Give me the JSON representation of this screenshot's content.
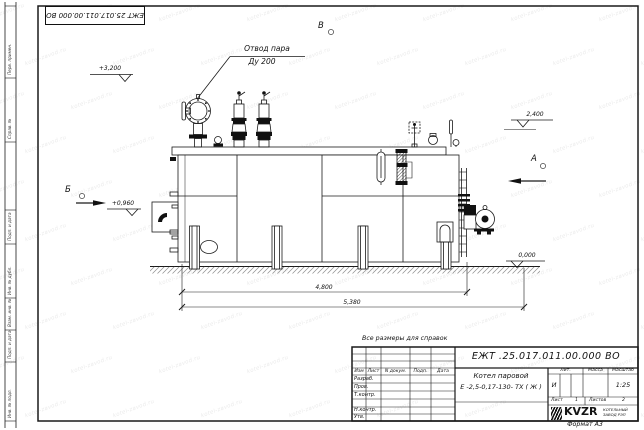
{
  "sheet": {
    "watermark": "kotel-zavod.ru",
    "format_note": "Формат А3",
    "reference_note": "Все размеры для справок",
    "top_doc_number": "ЕЖТ 25.017.011.00.000  ВО"
  },
  "drawing": {
    "callout": {
      "line1": "Отвод пара",
      "line2": "Ду 200"
    },
    "elevations": {
      "top_left": "+3,200",
      "right": "2,400",
      "left": "+0,960",
      "ground": "0,000"
    },
    "views": {
      "a": "А",
      "b": "Б",
      "v": "В"
    },
    "dims": {
      "length_body": "4,800",
      "length_total": "5,380"
    }
  },
  "title_block": {
    "doc_number": "ЕЖТ .25.017.011.00.000  ВО",
    "product_line1": "Котел паровой",
    "product_line2": "Е -2,5-0,17-130- ТХ ( Ж )",
    "headers": {
      "izm": "Изм",
      "list": "Лист",
      "doc": "N докум.",
      "podp": "Подп.",
      "data": "Дата",
      "lit": "Лит.",
      "mass": "Масса",
      "scale": "Масштаб",
      "sheet": "Лист",
      "sheets": "Листов"
    },
    "roles": [
      "Разраб.",
      "Пров.",
      "Т.контр.",
      "Н.контр.",
      "Утв."
    ],
    "lit_value": "И",
    "scale_value": "1:25",
    "sheet_value": "1",
    "sheets_value": "2",
    "company": {
      "logo": "KVZR",
      "name1": "КОТЕЛЬНЫЙ",
      "name2": "ЗАВОД РЭП"
    }
  },
  "side_strip": {
    "labels": [
      "Перв. примен.",
      "Справ. №",
      "Подп. и дата",
      "Инв. № дубл.",
      "Взам. инв. №",
      "Подп. и дата",
      "Инв. № подл."
    ]
  }
}
